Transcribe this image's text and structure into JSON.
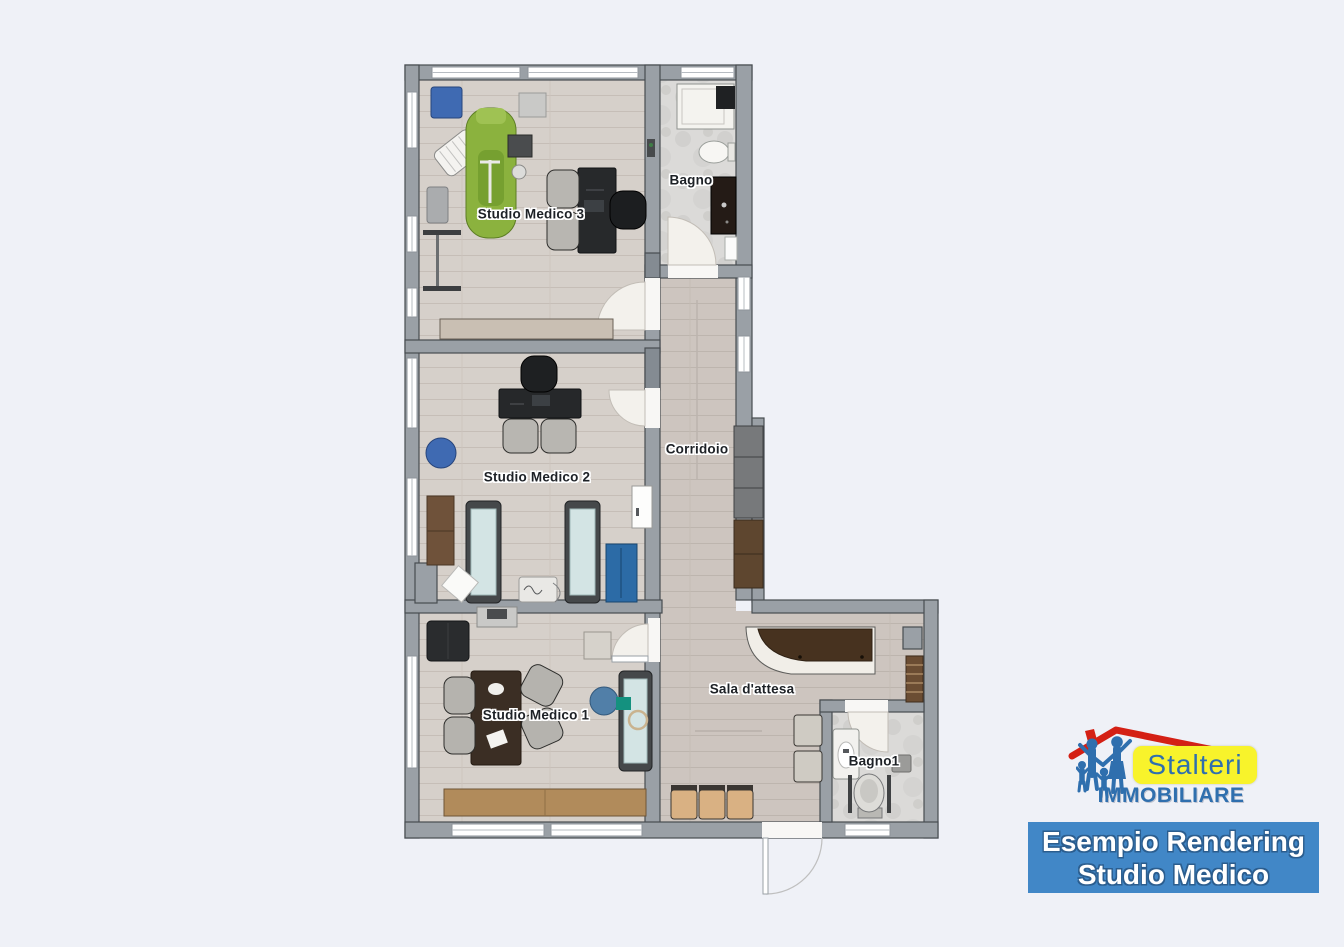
{
  "page": {
    "background": "#eff1f7"
  },
  "plan": {
    "title": "Studio Medico floor plan",
    "rooms": {
      "studio_medico_3": {
        "label": "Studio Medico 3"
      },
      "bagno": {
        "label": "Bagno"
      },
      "studio_medico_2": {
        "label": "Studio Medico 2"
      },
      "corridoio": {
        "label": "Corridoio"
      },
      "studio_medico_1": {
        "label": "Studio Medico 1"
      },
      "sala_attesa": {
        "label": "Sala d'attesa"
      },
      "bagno_1": {
        "label": "Bagno1"
      }
    },
    "colors": {
      "wall": "#9aa0a6",
      "wall_outline": "#474c51",
      "wood_floor": "#d6d0ca",
      "corridor_floor": "#cdc5bf",
      "marble_floor": "#dbdad8",
      "accent_blue_furniture": "#3f6ab2",
      "dental_chair_green": "#8bb23e",
      "exam_bed_teal": "#d3e4e4",
      "reception_wood": "#47321f",
      "waiting_chair_beige": "#d9b183"
    }
  },
  "branding": {
    "logo": {
      "name": "Stalteri",
      "subtitle": "IMMOBILIARE",
      "name_bg": "#f8f32b",
      "text_color": "#2f6fae",
      "roof_color": "#d42015"
    },
    "banner": {
      "line1": "Esempio Rendering",
      "line2": "Studio Medico",
      "bg": "#4187c7",
      "text_color": "#ffffff"
    }
  }
}
